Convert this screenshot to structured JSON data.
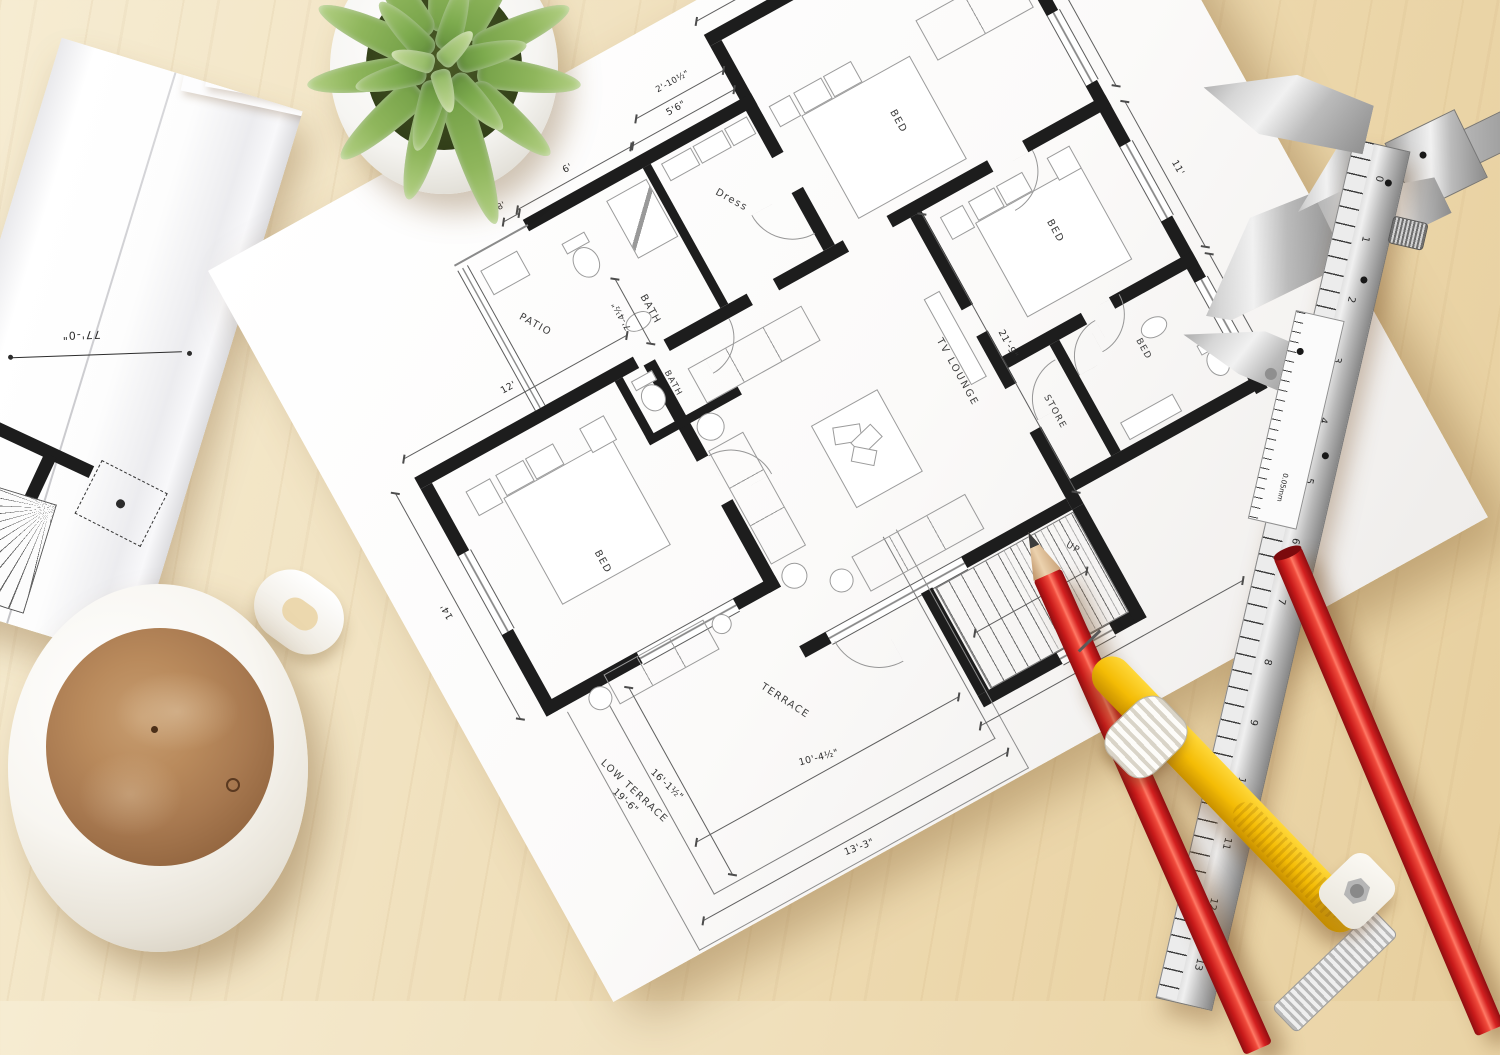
{
  "scene": {
    "setting": "architectural floor plan on wooden desk",
    "colors": {
      "desk": "#eed9b4",
      "paper": "#fbfaf9",
      "wall": "#1d1d1d",
      "pencil_red": "#d42020",
      "compass_yellow": "#f4bc05",
      "caliper_silver": "#c9c9c9",
      "coffee": "#a87950",
      "leaf_green": "#8fb65c"
    }
  },
  "floor_plan": {
    "room_labels": {
      "bed_top_right": "BED",
      "bed_left": "BED",
      "bed_right": "BED",
      "bed_bath": "BED",
      "bath_top": "BATH",
      "bath_mid": "BATH",
      "dress": "Dress",
      "patio": "PATIO",
      "tv_lounge": "TV LOUNGE",
      "store": "STORE",
      "terrace": "TERRACE",
      "low_terrace": "LOW TERRACE",
      "stairs": "UP"
    },
    "dimensions": {
      "top_right_width": "12'-6\"",
      "right_upper": "12'",
      "right_mid": "11'",
      "right_lower": "5'",
      "left_bed_width": "12'",
      "left_bed_height": "14'",
      "bath_width": "6'",
      "dress_width": "5'6\"",
      "patio_width": "8'",
      "top_small": "2'-10½\"",
      "bath_inner": "7'-4½\"",
      "lounge_height": "21'-9\"",
      "bottom_width": "21'",
      "terrace_bottom_outer": "13'-3\"",
      "terrace_bottom_inner": "10'-4½\"",
      "terrace_side": "16'-1½\"",
      "low_terrace_length": "19'-6\""
    }
  },
  "rolled_blueprint": {
    "width_dimension": "77'-0\"",
    "note_line1": "ENTRY",
    "note_line2": "BELOW",
    "note_line3": "5' CLG",
    "partial_label": "GALLERY"
  },
  "caliper": {
    "scale_numbers": [
      "0",
      "1",
      "2",
      "3",
      "4",
      "5",
      "6",
      "7",
      "8",
      "9",
      "10",
      "11",
      "12",
      "13"
    ],
    "vernier_label": "0.05mm"
  }
}
